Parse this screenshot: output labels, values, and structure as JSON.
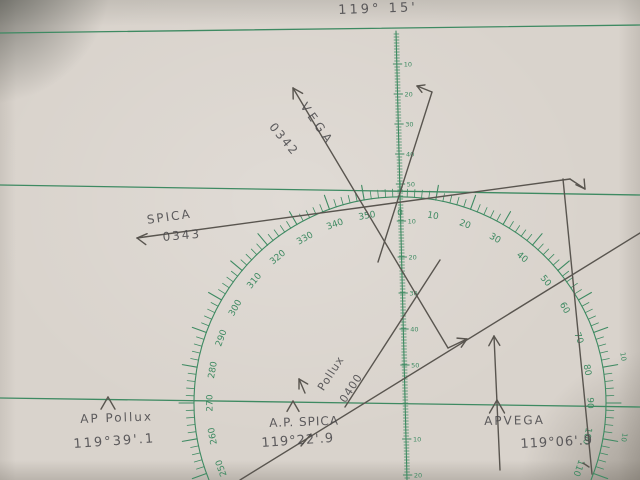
{
  "colors": {
    "ink_green": "#3e8a62",
    "pencil": "#59554f",
    "paper": "#d9d3cc"
  },
  "annotations": {
    "top_longitude": "119° 15'",
    "vega_star": "VEGA",
    "vega_time": "0342",
    "spica_star": "SPICA",
    "spica_time": "0343",
    "pollux_star": "Pollux",
    "pollux_time": "0400",
    "ap_pollux_label": "AP Pollux",
    "ap_pollux_longitude": "119°39'.1",
    "ap_spica_label": "A.P. SPICA",
    "ap_spica_longitude": "119°22'.9",
    "ap_vega_label": "APVEGA",
    "ap_vega_longitude": "119°06'.9"
  },
  "compass_rose": {
    "label_step_deg": 10,
    "start_bearing_deg": 250,
    "labels": [
      "250",
      "260",
      "270",
      "280",
      "290",
      "300",
      "310",
      "320",
      "330",
      "340",
      "350",
      "0",
      "10",
      "20",
      "30",
      "40",
      "50",
      "60",
      "70",
      "80",
      "90",
      "100",
      "110"
    ]
  },
  "mid_scale": {
    "upper_labels": [
      "10",
      "20",
      "30",
      "40",
      "50"
    ],
    "middle_labels": [
      "10",
      "20",
      "30",
      "40",
      "50"
    ],
    "lower_labels": [
      "10",
      "20"
    ]
  },
  "edge_scale": {
    "labels": [
      "10",
      "10"
    ]
  }
}
